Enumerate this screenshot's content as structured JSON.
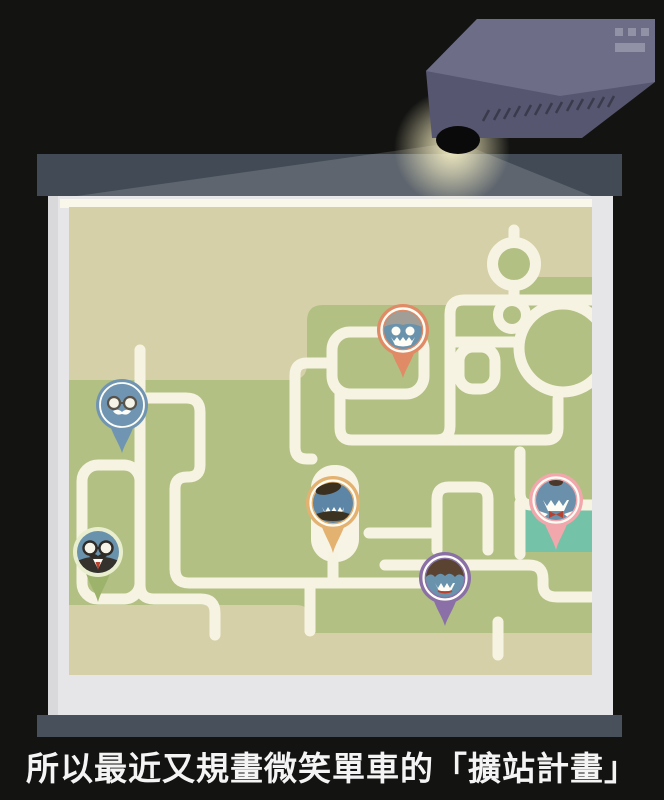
{
  "caption": {
    "text": "所以最近又規畫微笑單車的「擴站計畫」"
  },
  "colors": {
    "background": "#131312",
    "top_bar": "#424b55",
    "bottom_bar": "#47505b",
    "screen": "#e6e6e8",
    "screen_shade": "#d9d9db",
    "screen_trim": "#f9f7e9",
    "map_base": "#d6d0a8",
    "map_green": "#b2c083",
    "map_teal": "#74c2a7",
    "road": "#f6f3e2",
    "plaza": "#f7f4e6",
    "projector_top": "#6d6d87",
    "projector_front": "#565670",
    "projector_detail": "#9292a6",
    "projector_vent": "#3a3a4c",
    "lens": "#0a0a0a",
    "beam_glow": "#fdf6c8",
    "face_blue": "#6992ad",
    "caption_text": "#f4f4f4"
  },
  "map": {
    "pins": [
      {
        "name": "robot-grin",
        "color": "#e08a66"
      },
      {
        "name": "glasses-mustache",
        "color": "#7095b3"
      },
      {
        "name": "beret-grin",
        "color": "#e3b271"
      },
      {
        "name": "professor-suit",
        "color": "#9db36c"
      },
      {
        "name": "curly-hair-grin",
        "color": "#8a70a7"
      },
      {
        "name": "bowtie-grin",
        "color": "#f2a7ac"
      }
    ]
  }
}
